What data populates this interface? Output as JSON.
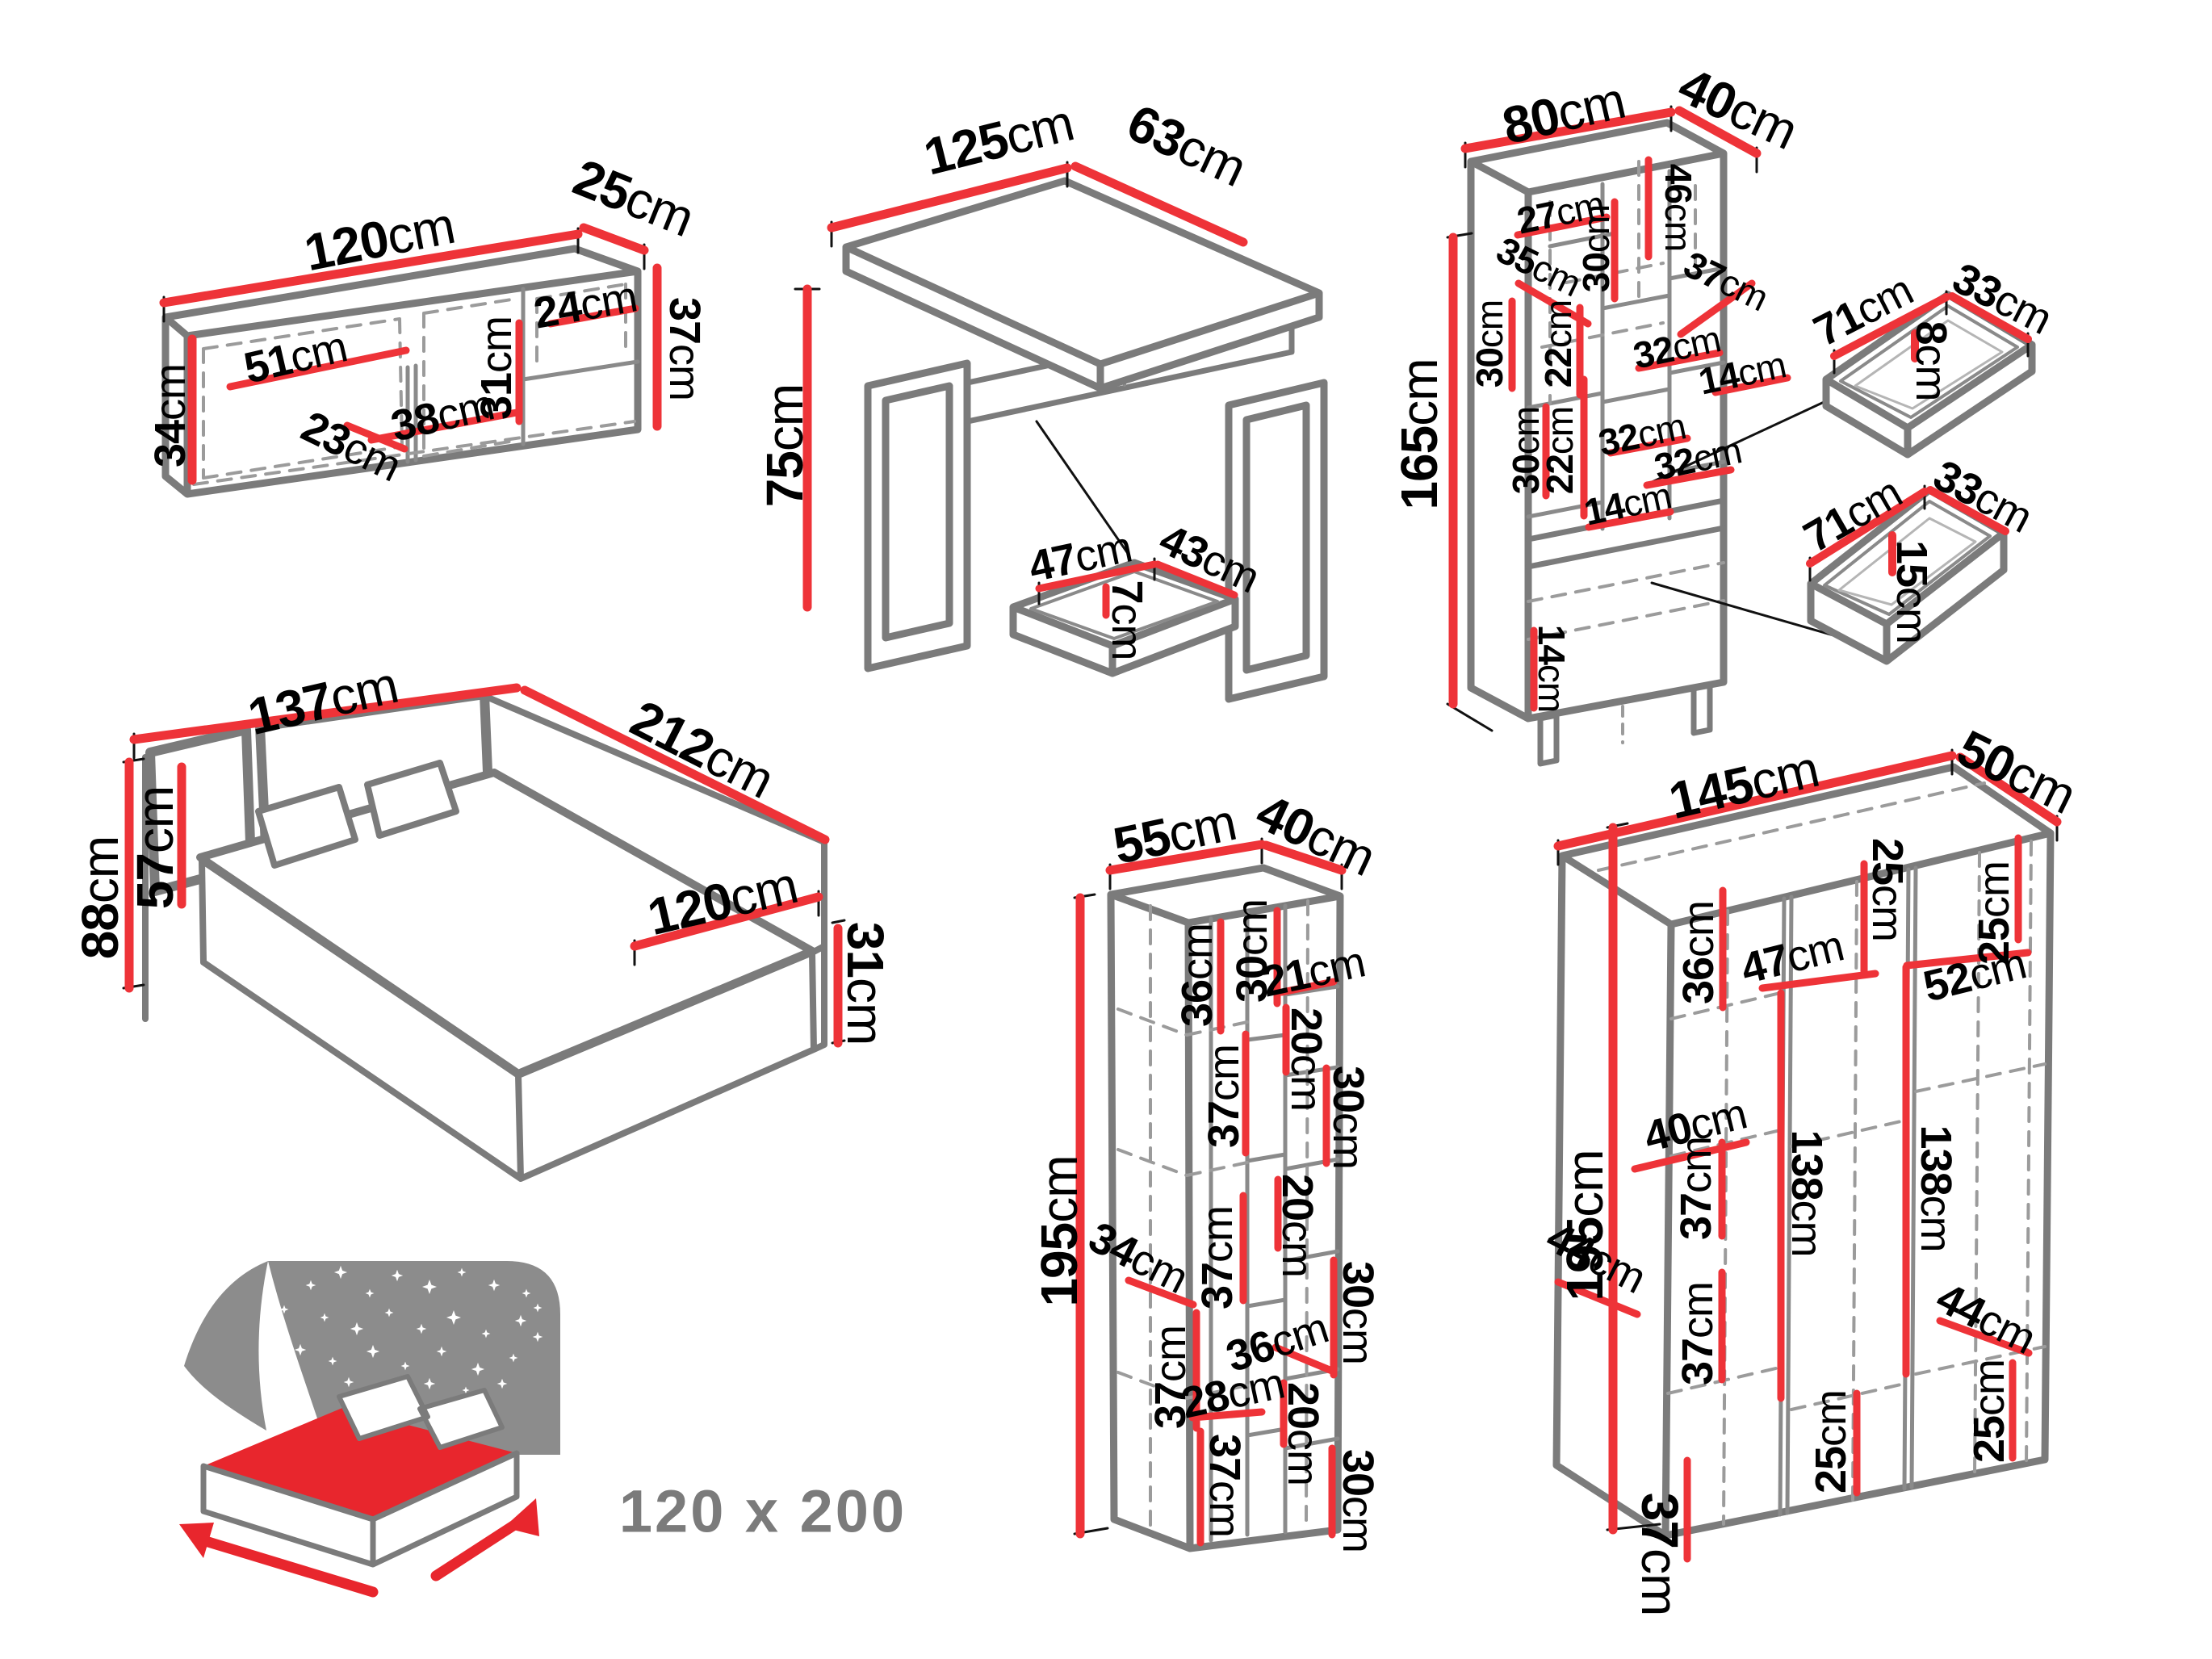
{
  "colors": {
    "dimension_red": "#ee3338",
    "outline_gray": "#7b7b7b",
    "inner_gray": "#8a8a8a",
    "dash_gray": "#9b9b9b",
    "panel_gray": "#8c8c8c",
    "icon_red": "#e8262d",
    "text_black": "#000000",
    "badge_gray": "#7b7b7b"
  },
  "bed_badge": {
    "value": "120 x 200"
  },
  "pieces": {
    "wall_cabinet": {
      "dims": [
        {
          "v": "120",
          "u": "cm"
        },
        {
          "v": "25",
          "u": "cm"
        },
        {
          "v": "37",
          "u": "cm"
        },
        {
          "v": "34",
          "u": "cm"
        },
        {
          "v": "51",
          "u": "cm"
        },
        {
          "v": "23",
          "u": "cm"
        },
        {
          "v": "38",
          "u": "cm"
        },
        {
          "v": "31",
          "u": "cm"
        },
        {
          "v": "24",
          "u": "cm"
        }
      ]
    },
    "desk": {
      "dims": [
        {
          "v": "125",
          "u": "cm"
        },
        {
          "v": "63",
          "u": "cm"
        },
        {
          "v": "75",
          "u": "cm"
        }
      ]
    },
    "desk_drawer": {
      "dims": [
        {
          "v": "47",
          "u": "cm"
        },
        {
          "v": "43",
          "u": "cm"
        },
        {
          "v": "7",
          "u": "cm"
        }
      ]
    },
    "bookcase": {
      "dims": [
        {
          "v": "80",
          "u": "cm"
        },
        {
          "v": "40",
          "u": "cm"
        },
        {
          "v": "165",
          "u": "cm"
        },
        {
          "v": "27",
          "u": "cm"
        },
        {
          "v": "35",
          "u": "cm"
        },
        {
          "v": "30",
          "u": "cm"
        },
        {
          "v": "46",
          "u": "cm"
        },
        {
          "v": "37",
          "u": "cm"
        },
        {
          "v": "32",
          "u": "cm"
        },
        {
          "v": "14",
          "u": "cm"
        },
        {
          "v": "22",
          "u": "cm"
        },
        {
          "v": "22",
          "u": "cm"
        },
        {
          "v": "30",
          "u": "cm"
        },
        {
          "v": "30",
          "u": "cm"
        },
        {
          "v": "32",
          "u": "cm"
        },
        {
          "v": "32",
          "u": "cm"
        },
        {
          "v": "14",
          "u": "cm"
        },
        {
          "v": "14",
          "u": "cm"
        }
      ]
    },
    "drawer_shallow": {
      "dims": [
        {
          "v": "71",
          "u": "cm"
        },
        {
          "v": "33",
          "u": "cm"
        },
        {
          "v": "8",
          "u": "cm"
        }
      ]
    },
    "drawer_deep": {
      "dims": [
        {
          "v": "71",
          "u": "cm"
        },
        {
          "v": "33",
          "u": "cm"
        },
        {
          "v": "15",
          "u": "cm"
        }
      ]
    },
    "bed": {
      "dims": [
        {
          "v": "137",
          "u": "cm"
        },
        {
          "v": "212",
          "u": "cm"
        },
        {
          "v": "88",
          "u": "cm"
        },
        {
          "v": "57",
          "u": "cm"
        },
        {
          "v": "120",
          "u": "cm"
        },
        {
          "v": "31",
          "u": "cm"
        }
      ]
    },
    "tall_cabinet": {
      "dims": [
        {
          "v": "55",
          "u": "cm"
        },
        {
          "v": "40",
          "u": "cm"
        },
        {
          "v": "195",
          "u": "cm"
        },
        {
          "v": "36",
          "u": "cm"
        },
        {
          "v": "30",
          "u": "cm"
        },
        {
          "v": "21",
          "u": "cm"
        },
        {
          "v": "20",
          "u": "cm"
        },
        {
          "v": "30",
          "u": "cm"
        },
        {
          "v": "37",
          "u": "cm"
        },
        {
          "v": "20",
          "u": "cm"
        },
        {
          "v": "34",
          "u": "cm"
        },
        {
          "v": "37",
          "u": "cm"
        },
        {
          "v": "30",
          "u": "cm"
        },
        {
          "v": "36",
          "u": "cm"
        },
        {
          "v": "28",
          "u": "cm"
        },
        {
          "v": "37",
          "u": "cm"
        },
        {
          "v": "20",
          "u": "cm"
        },
        {
          "v": "37",
          "u": "cm"
        },
        {
          "v": "30",
          "u": "cm"
        }
      ]
    },
    "wardrobe": {
      "dims": [
        {
          "v": "145",
          "u": "cm"
        },
        {
          "v": "50",
          "u": "cm"
        },
        {
          "v": "195",
          "u": "cm"
        },
        {
          "v": "36",
          "u": "cm"
        },
        {
          "v": "25",
          "u": "cm"
        },
        {
          "v": "25",
          "u": "cm"
        },
        {
          "v": "47",
          "u": "cm"
        },
        {
          "v": "52",
          "u": "cm"
        },
        {
          "v": "37",
          "u": "cm"
        },
        {
          "v": "40",
          "u": "cm"
        },
        {
          "v": "138",
          "u": "cm"
        },
        {
          "v": "138",
          "u": "cm"
        },
        {
          "v": "44",
          "u": "cm"
        },
        {
          "v": "37",
          "u": "cm"
        },
        {
          "v": "44",
          "u": "cm"
        },
        {
          "v": "25",
          "u": "cm"
        },
        {
          "v": "25",
          "u": "cm"
        },
        {
          "v": "37",
          "u": "cm"
        }
      ]
    }
  }
}
